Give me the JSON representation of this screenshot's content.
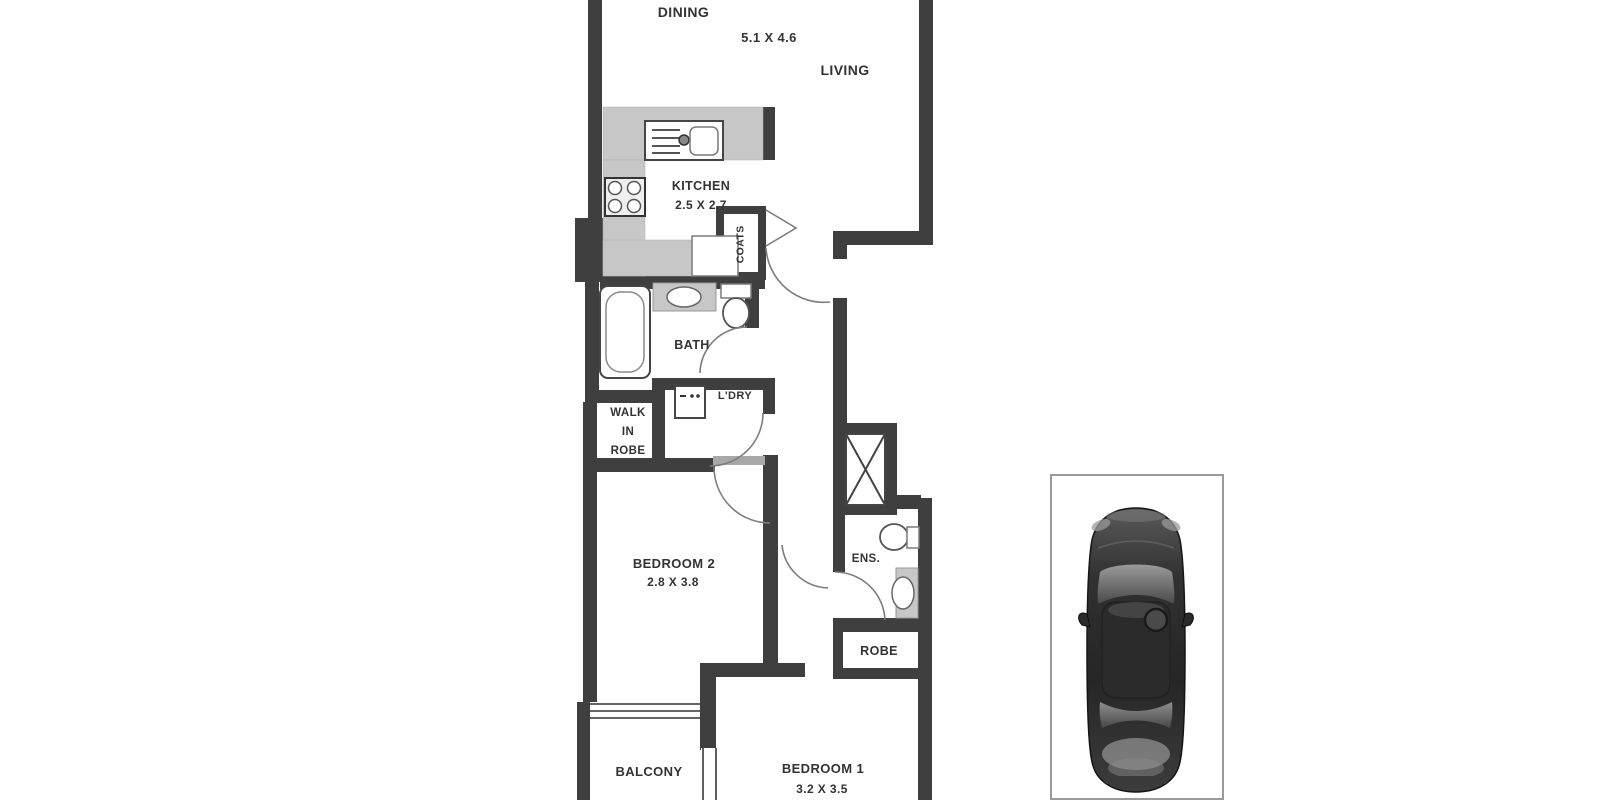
{
  "rooms": {
    "dining": {
      "name": "DINING",
      "dims": "5.1 X 4.6"
    },
    "living": {
      "name": "LIVING"
    },
    "kitchen": {
      "name": "KITCHEN",
      "dims": "2.5 X 2.7"
    },
    "coats": {
      "name": "COATS"
    },
    "bath": {
      "name": "BATH"
    },
    "laundry": {
      "name": "L'DRY"
    },
    "walk_in_robe": {
      "name": "WALK\nIN\nROBE"
    },
    "bedroom2": {
      "name": "BEDROOM 2",
      "dims": "2.8 X 3.8"
    },
    "ensuite": {
      "name": "ENS."
    },
    "robe": {
      "name": "ROBE"
    },
    "balcony": {
      "name": "BALCONY"
    },
    "bedroom1": {
      "name": "BEDROOM 1",
      "dims": "3.2 X 3.5"
    }
  },
  "colors": {
    "wall": "#3f3f3f",
    "counter": "#c7c7c7",
    "text": "#333333",
    "parking_border": "#9a9a9a",
    "car_body": "#2e2e2e"
  }
}
